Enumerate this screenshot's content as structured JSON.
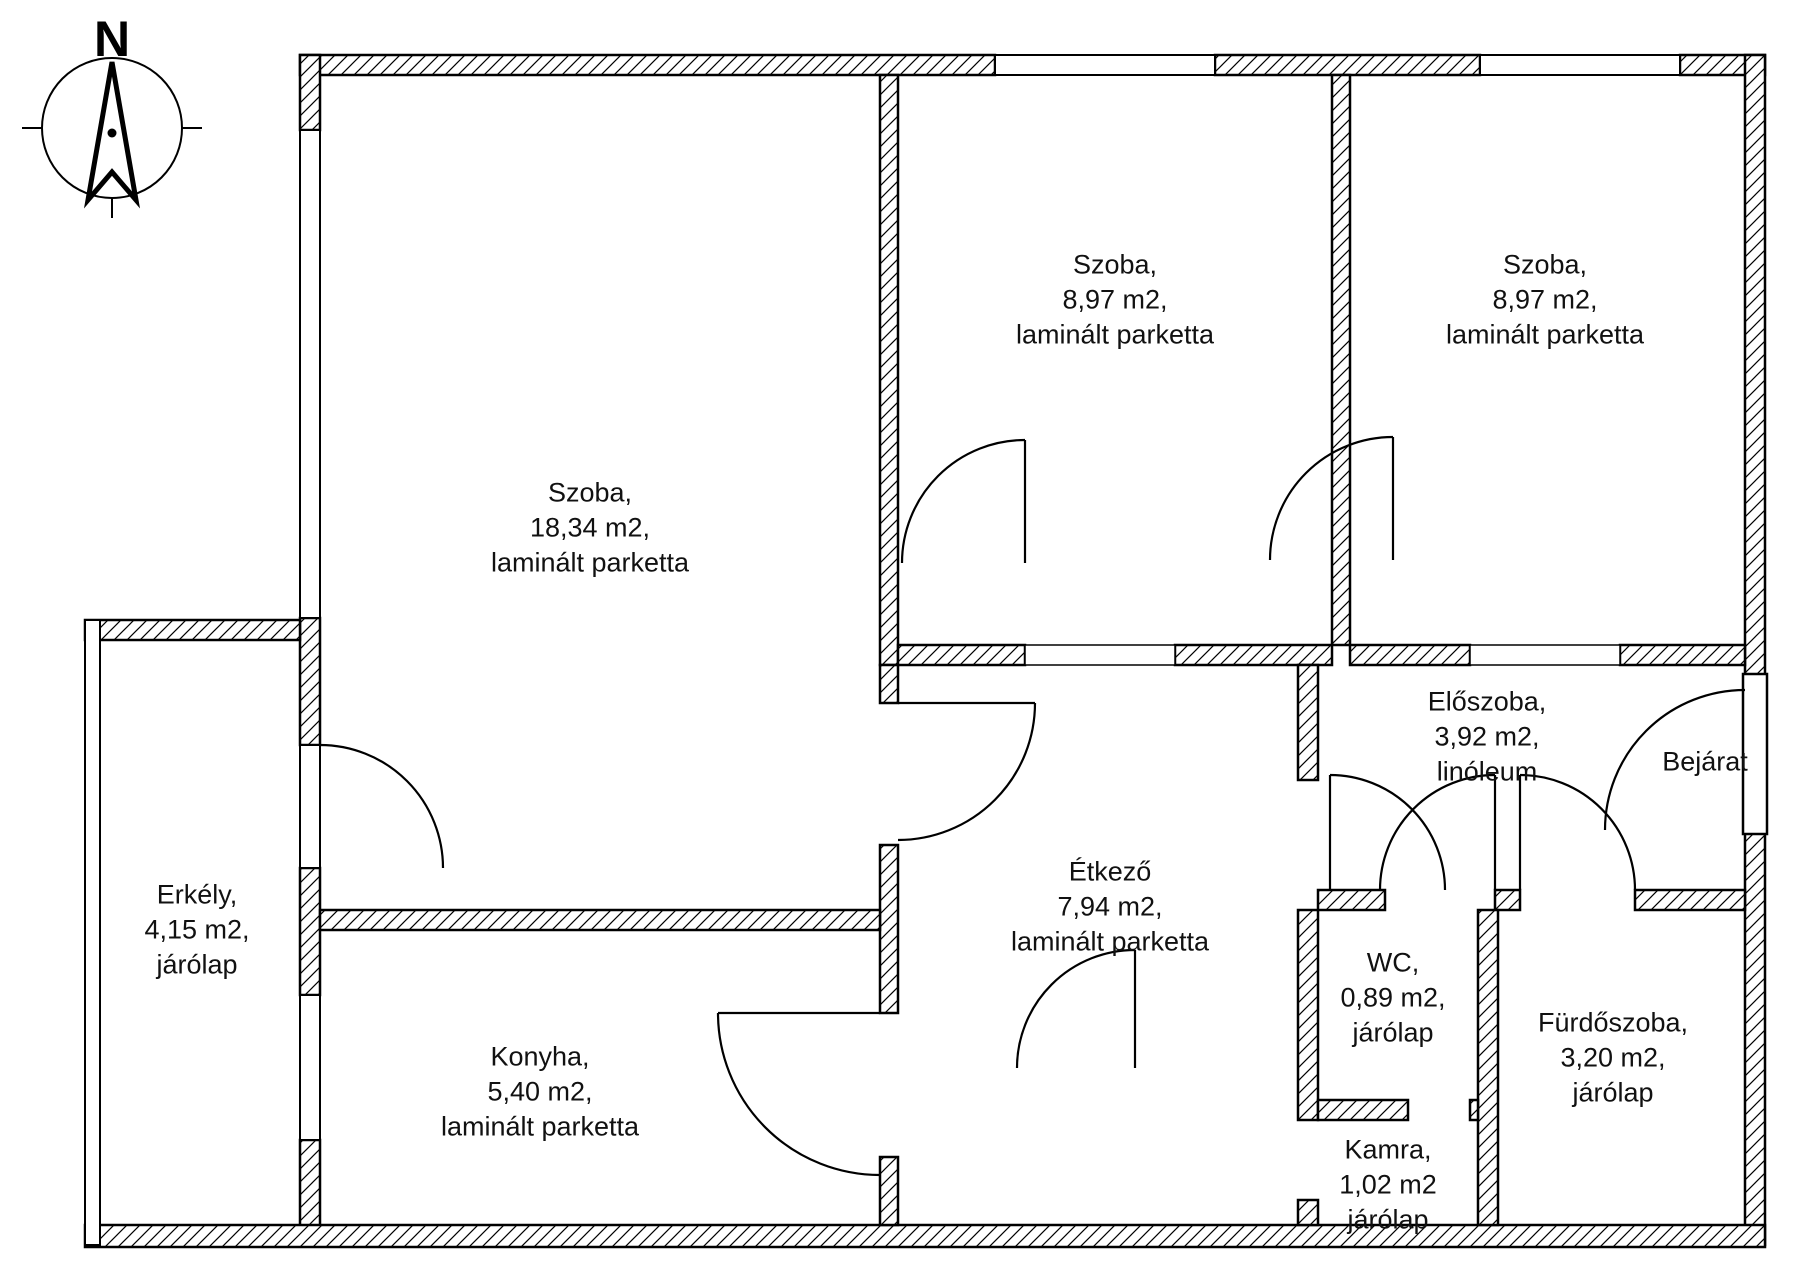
{
  "compass": {
    "north_label": "N"
  },
  "entrance": {
    "label": "Bejárat"
  },
  "rooms": [
    {
      "id": "szoba-large",
      "name": "Szoba,",
      "area": "18,34 m2,",
      "floor": "laminált parketta"
    },
    {
      "id": "szoba-middle",
      "name": "Szoba,",
      "area": "8,97 m2,",
      "floor": "laminált parketta"
    },
    {
      "id": "szoba-right",
      "name": "Szoba,",
      "area": "8,97 m2,",
      "floor": "laminált parketta"
    },
    {
      "id": "eloszoba",
      "name": "Előszoba,",
      "area": "3,92 m2,",
      "floor": "linóleum"
    },
    {
      "id": "erkely",
      "name": "Erkély,",
      "area": "4,15 m2,",
      "floor": "járólap"
    },
    {
      "id": "etkezo",
      "name": "Étkező",
      "area": "7,94 m2,",
      "floor": "laminált parketta"
    },
    {
      "id": "konyha",
      "name": "Konyha,",
      "area": "5,40 m2,",
      "floor": "laminált parketta"
    },
    {
      "id": "wc",
      "name": "WC,",
      "area": "0,89 m2,",
      "floor": "járólap"
    },
    {
      "id": "furdoszoba",
      "name": "Fürdőszoba,",
      "area": "3,20 m2,",
      "floor": "járólap"
    },
    {
      "id": "kamra",
      "name": "Kamra,",
      "area": "1,02 m2",
      "floor": "járólap"
    }
  ]
}
